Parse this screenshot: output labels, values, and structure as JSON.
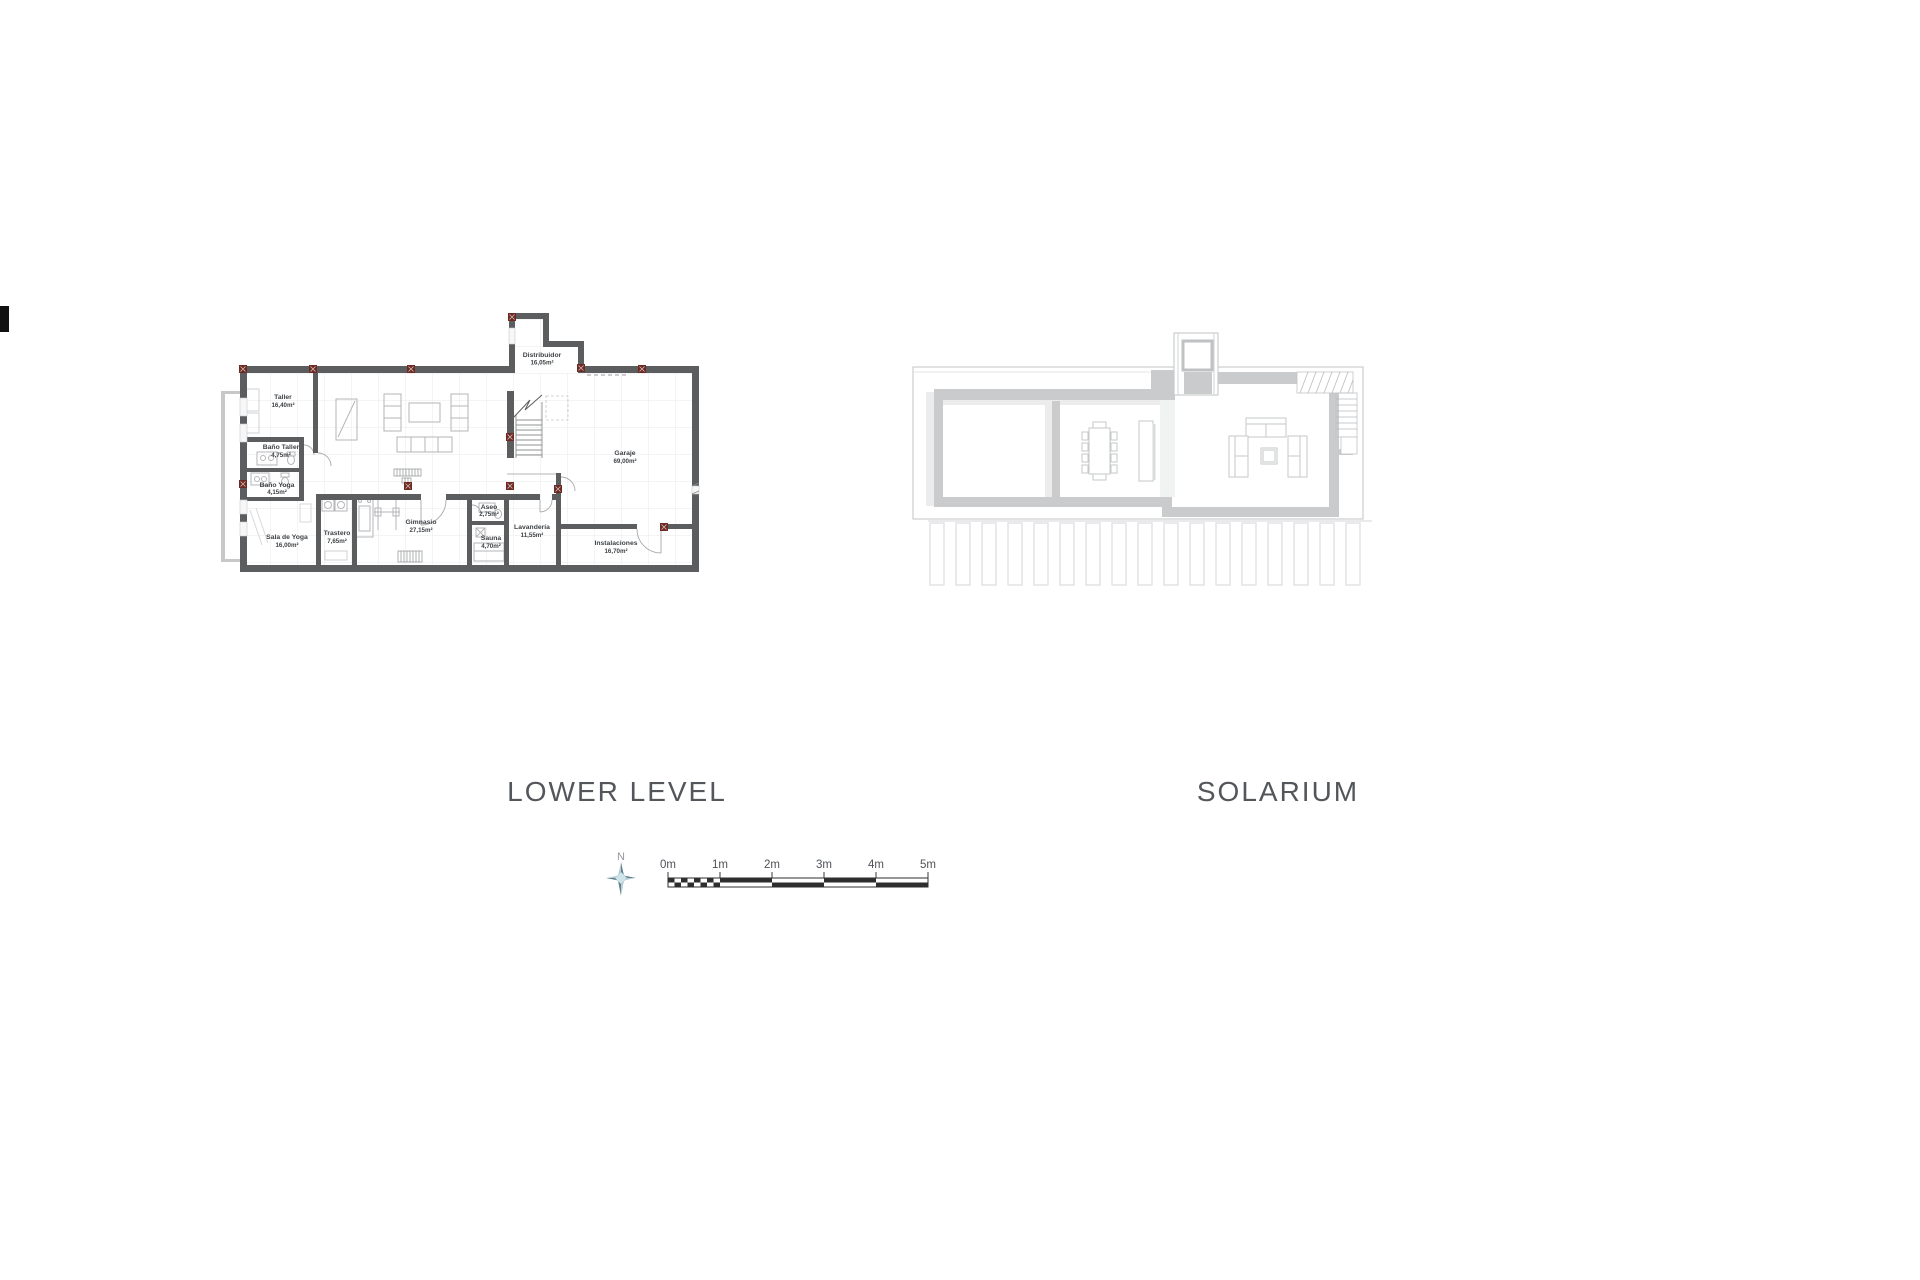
{
  "page": {
    "background": "#ffffff"
  },
  "lower_level": {
    "title": "LOWER LEVEL",
    "rooms": [
      {
        "name": "Taller",
        "area": "16,40m²"
      },
      {
        "name": "Baño Taller",
        "area": "4,75m²"
      },
      {
        "name": "Baño Yoga",
        "area": "4,15m²"
      },
      {
        "name": "Sala de Yoga",
        "area": "16,00m²"
      },
      {
        "name": "Trastero",
        "area": "7,65m²"
      },
      {
        "name": "Gimnasio",
        "area": "27,15m²"
      },
      {
        "name": "Aseo",
        "area": "2,75m²"
      },
      {
        "name": "Sauna",
        "area": "4,70m²"
      },
      {
        "name": "Lavandería",
        "area": "11,55m²"
      },
      {
        "name": "Instalaciones",
        "area": "16,70m²"
      },
      {
        "name": "Garaje",
        "area": "69,00m²"
      },
      {
        "name": "Distribuidor",
        "area": "16,05m²"
      }
    ]
  },
  "solarium": {
    "title": "SOLARIUM"
  },
  "compass": {
    "north_label": "N"
  },
  "scale_bar": {
    "labels": [
      "0m",
      "1m",
      "2m",
      "3m",
      "4m",
      "5m"
    ]
  },
  "colors": {
    "wall_dark": "#5c5d5f",
    "wall_light": "#c9cbcd",
    "marker_red": "#6e2a22",
    "title_text": "#53565a",
    "compass_teal": "#5f828c",
    "scalebar_black": "#2e2e2e"
  }
}
